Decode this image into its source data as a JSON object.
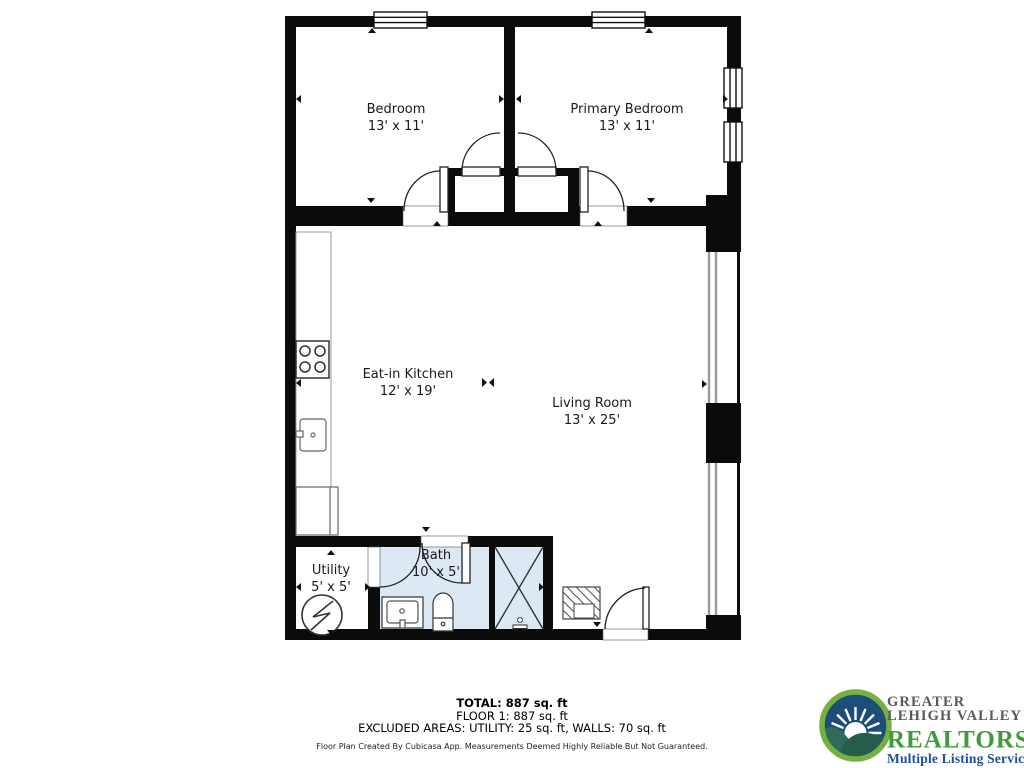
{
  "floor_plan": {
    "rooms": [
      {
        "name": "Bedroom",
        "dimensions": "13' x 11'"
      },
      {
        "name": "Primary Bedroom",
        "dimensions": "13' x 11'"
      },
      {
        "name": "Eat-in Kitchen",
        "dimensions": "12' x 19'"
      },
      {
        "name": "Living Room",
        "dimensions": "13' x 25'"
      },
      {
        "name": "Utility",
        "dimensions": "5' x 5'"
      },
      {
        "name": "Bath",
        "dimensions": "10' x 5'"
      }
    ],
    "colors": {
      "wall": "#0b0b0b",
      "bath_fill": "#dce9f4",
      "floor_fill": "#ffffff",
      "window_gray": "#9a9a9a"
    }
  },
  "summary": {
    "total": "TOTAL: 887 sq. ft",
    "floor1": "FLOOR 1: 887 sq. ft",
    "excluded": "EXCLUDED AREAS: UTILITY: 25 sq. ft, WALLS: 70 sq. ft",
    "disclaimer": "Floor Plan Created By Cubicasa App. Measurements Deemed Highly Reliable But Not Guaranteed."
  },
  "logo": {
    "line1": "GREATER",
    "line2": "LEHIGH VALLEY",
    "line3": "REALTORS",
    "registered": "®",
    "tagline": "Multiple Listing Service",
    "colors": {
      "gray": "#58595b",
      "green": "#3f9b3c",
      "blue": "#1d4f9d",
      "ring_green": "#76b043",
      "sky_blue": "#1d4e79",
      "hill_green": "#2f6b58"
    }
  }
}
